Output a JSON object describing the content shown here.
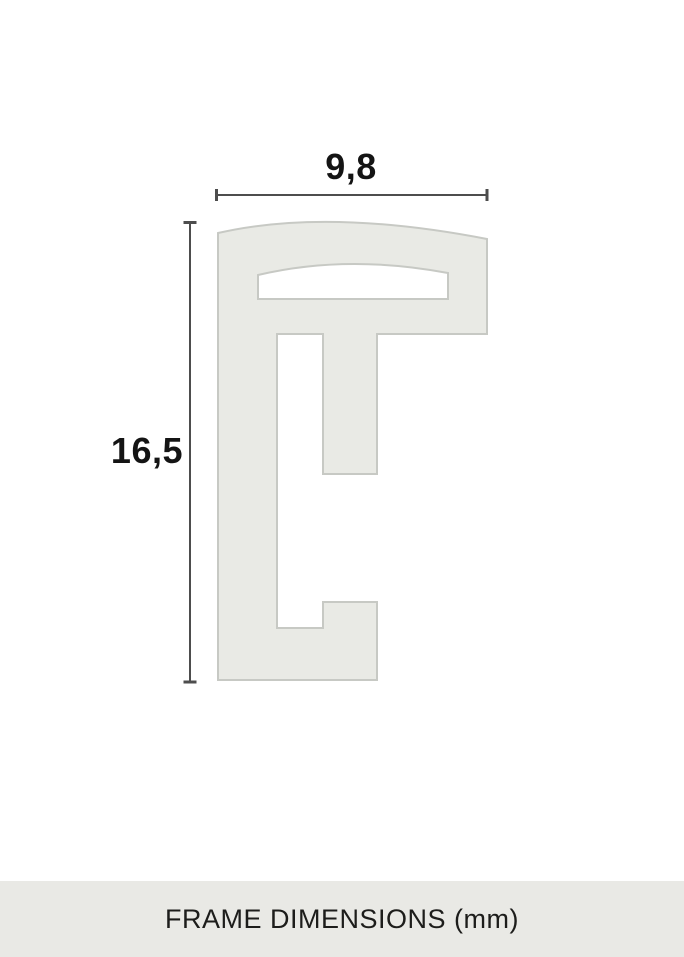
{
  "dimensions": {
    "width_label": "9,8",
    "height_label": "16,5"
  },
  "footer": {
    "title": "FRAME DIMENSIONS (mm)"
  },
  "colors": {
    "background": "#ffffff",
    "profile_fill": "#e9eae5",
    "profile_stroke": "#c7c9c4",
    "dimension_line": "#4d4d4d",
    "label_text": "#141414",
    "footer_bg": "#e9e9e5",
    "footer_text": "#1d1d1b"
  }
}
